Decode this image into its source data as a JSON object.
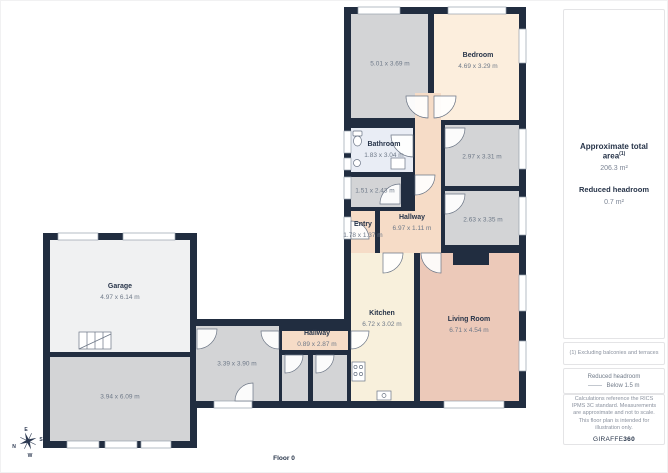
{
  "floor_label": "Floor 0",
  "compass": {
    "n": "N",
    "e": "E",
    "s": "S",
    "w": "W"
  },
  "colors": {
    "wall": "#212d40",
    "floor_gray": "#d3d4d6",
    "floor_garage": "#f0f1f2",
    "floor_bedroom": "#fceedd",
    "floor_hallway": "#f6dcc7",
    "floor_living": "#ecc9b9",
    "floor_kitchen": "#f8f0dc",
    "floor_bathroom": "#e9edf5",
    "text_navy": "#273449",
    "text_gray": "#6e7988"
  },
  "rooms": {
    "room_a": {
      "dims": "5.01 x 3.69 m"
    },
    "bedroom": {
      "name": "Bedroom",
      "dims": "4.69 x 3.29 m"
    },
    "bathroom": {
      "name": "Bathroom",
      "dims": "1.83 x 3.04 m"
    },
    "room_b": {
      "dims": "2.97 x 3.31 m"
    },
    "room_c": {
      "dims": "1.51 x 2.43 m"
    },
    "room_d": {
      "dims": "2.63 x 3.35 m"
    },
    "entry": {
      "name": "Entry",
      "dims": "1.78 x 1.37 m"
    },
    "hallway_main": {
      "name": "Hallway",
      "dims": "6.97 x 1.11 m"
    },
    "garage": {
      "name": "Garage",
      "dims": "4.97 x 6.14 m"
    },
    "room_e": {
      "dims": "3.39 x 3.90 m"
    },
    "hallway_small": {
      "name": "Hallway",
      "dims": "0.89 x 2.87 m"
    },
    "room_f": {
      "dims": "3.94 x 6.09 m"
    },
    "kitchen": {
      "name": "Kitchen",
      "dims": "6.72 x 3.02 m"
    },
    "living_room": {
      "name": "Living Room",
      "dims": "6.71 x 4.54 m"
    }
  },
  "sidebar": {
    "total_area_label": "Approximate total area",
    "total_area_superscript": "(1)",
    "total_area_value": "206.3 m²",
    "headroom_label": "Reduced headroom",
    "headroom_value": "0.7 m²",
    "footnote": "(1) Excluding balconies and terraces",
    "legend_title": "Reduced headroom",
    "legend_item": "Below 1.5 m",
    "disclaimer": "Calculations reference the RICS IPMS 3C standard. Measurements are approximate and not to scale. This floor plan is intended for illustration only.",
    "brand_name": "GIRAFFE",
    "brand_suffix": "360"
  }
}
